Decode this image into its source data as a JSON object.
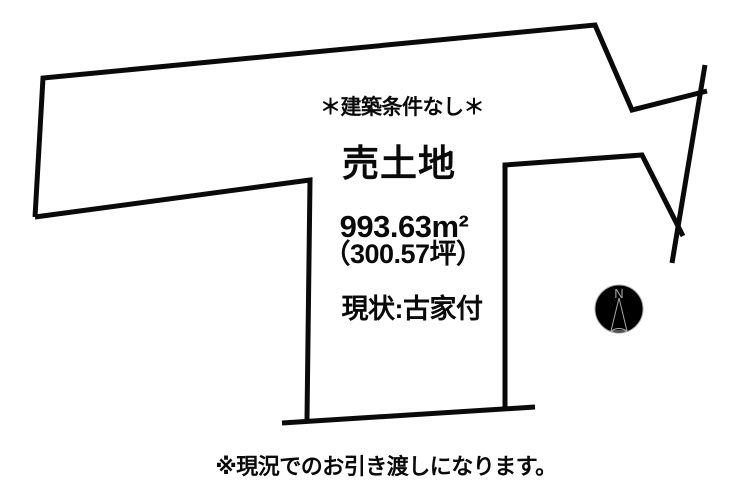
{
  "diagram": {
    "type": "land-plot-for-sale",
    "condition_note": "＊建築条件なし＊",
    "title": "売土地",
    "area_m2": "993.63m²",
    "area_tsubo": "（300.57坪）",
    "current_state": "現状:古家付",
    "footer_note": "※現況でのお引き渡しになります。",
    "compass": {
      "north_label": "N"
    },
    "colors": {
      "line": "#0a0a0a",
      "text": "#0a0a0a",
      "compass": "#a8a8a8",
      "background": "#ffffff"
    }
  }
}
